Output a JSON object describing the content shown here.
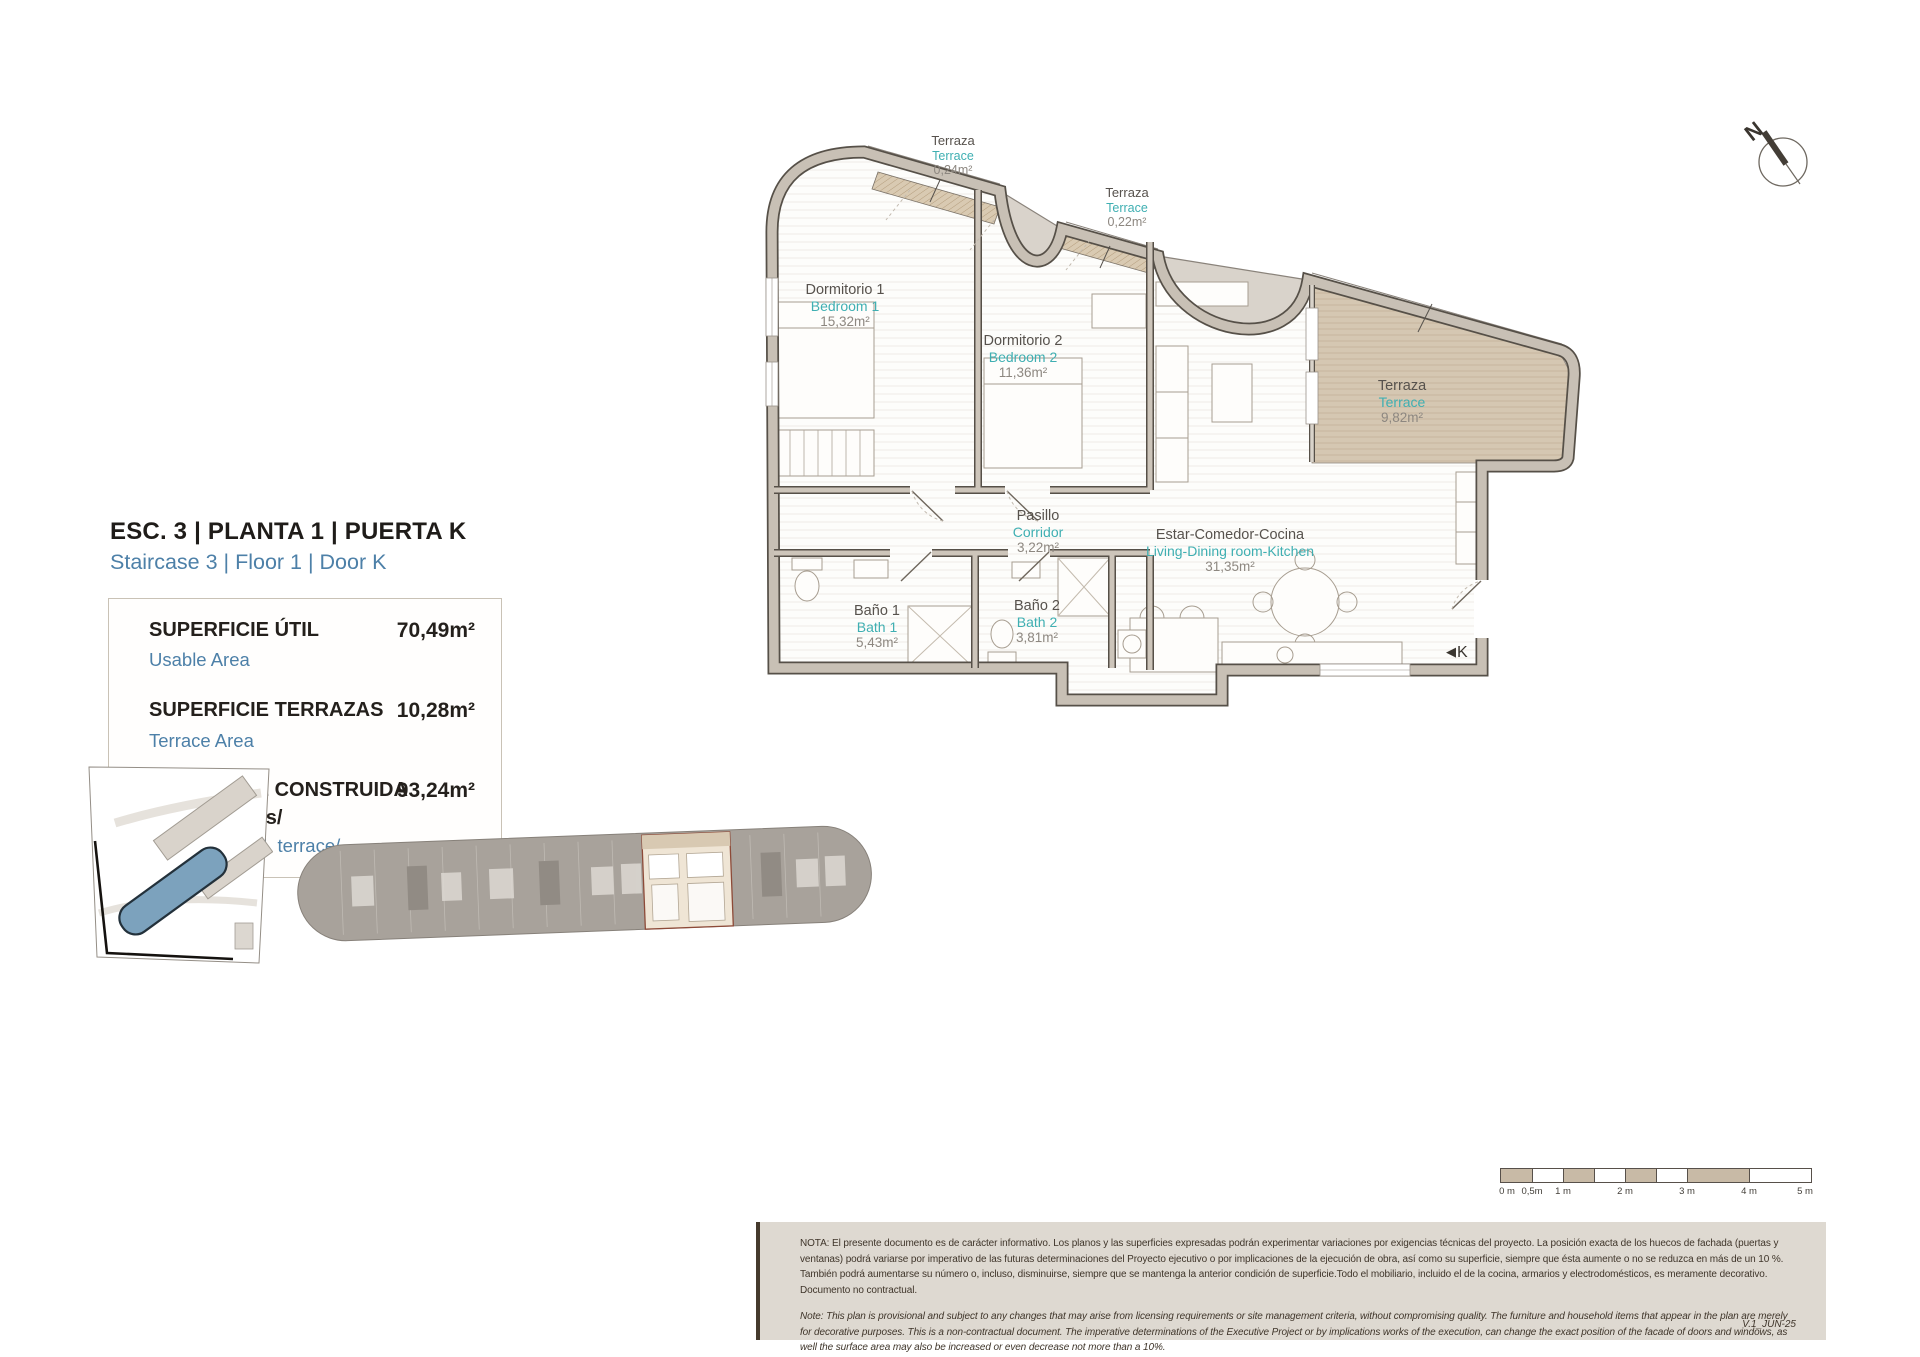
{
  "header": {
    "title_es": "ESC. 3 | PLANTA 1 | PUERTA K",
    "title_en": "Staircase 3 | Floor 1 | Door K"
  },
  "area_table": {
    "rows": [
      {
        "label_es": "SUPERFICIE ÚTIL",
        "label_en": "Usable Area",
        "value": "70,49m²"
      },
      {
        "label_es": "SUPERFICIE TERRAZAS",
        "label_en": "Terrace Area",
        "value": "10,28m²"
      },
      {
        "label_es": "SUPERFICIE CONSTRUIDA",
        "label_es2": "/Incl. terrazas/",
        "label_en": "Built Area /Incl. terrace/",
        "value": "93,24m²"
      }
    ]
  },
  "floorplan": {
    "rooms": [
      {
        "id": "terrace-top-1",
        "name_es": "Terraza",
        "name_en": "Terrace",
        "area": "0,24m²"
      },
      {
        "id": "terrace-top-2",
        "name_es": "Terraza",
        "name_en": "Terrace",
        "area": "0,22m²"
      },
      {
        "id": "bedroom-1",
        "name_es": "Dormitorio 1",
        "name_en": "Bedroom 1",
        "area": "15,32m²"
      },
      {
        "id": "bedroom-2",
        "name_es": "Dormitorio 2",
        "name_en": "Bedroom 2",
        "area": "11,36m²"
      },
      {
        "id": "terrace-main",
        "name_es": "Terraza",
        "name_en": "Terrace",
        "area": "9,82m²"
      },
      {
        "id": "corridor",
        "name_es": "Pasillo",
        "name_en": "Corridor",
        "area": "3,22m²"
      },
      {
        "id": "living",
        "name_es": "Estar-Comedor-Cocina",
        "name_en": "Living-Dining room-Kitchen",
        "area": "31,35m²"
      },
      {
        "id": "bath-1",
        "name_es": "Baño 1",
        "name_en": "Bath 1",
        "area": "5,43m²"
      },
      {
        "id": "bath-2",
        "name_es": "Baño 2",
        "name_en": "Bath 2",
        "area": "3,81m²"
      }
    ],
    "entrance_icon": "◀",
    "entrance_label": "K",
    "compass_n": "N"
  },
  "scale_bar": {
    "labels": [
      "0 m",
      "0,5m",
      "1 m",
      "2 m",
      "3 m",
      "4 m",
      "5 m"
    ]
  },
  "notes": {
    "es": "NOTA:  El presente documento es de carácter informativo. Los planos y las superficies expresadas podrán experimentar variaciones por exigencias técnicas del proyecto. La posición exacta de los huecos de fachada (puertas y ventanas) podrá variarse por imperativo de las futuras determinaciones del Proyecto ejecutivo o por implicaciones de la ejecución de obra, así como su superficie, siempre que ésta aumente o no se reduzca en más de un 10 %. También podrá aumentarse su número o, incluso, disminuirse, siempre que se mantenga la anterior condición de superficie.Todo el mobiliario, incluido el de la cocina, armarios y electrodomésticos, es meramente decorativo. Documento no contractual.",
    "en": "Note: This plan is provisional and subject to any changes that may arise from licensing requirements or site management criteria, without compromising quality. The furniture and household items that appear in the plan are merely for decorative purposes. This is a non-contractual document. The imperative determinations of the Executive Project or by implications works of the execution, can change the exact position of the facade of doors and windows, as well the surface area may also be increased or even decrease not more than a 10%.",
    "version": "V.1_JUN-25"
  },
  "colors": {
    "accent_blue": "#4d80a8",
    "accent_teal": "#3fafb2",
    "wall_grey": "#c8c0b5",
    "terrace_tan": "#d5c7b2",
    "highlight_cream": "#efe5d5",
    "note_bg": "#ded9d1",
    "site_building_blue": "#7ca2bd"
  }
}
